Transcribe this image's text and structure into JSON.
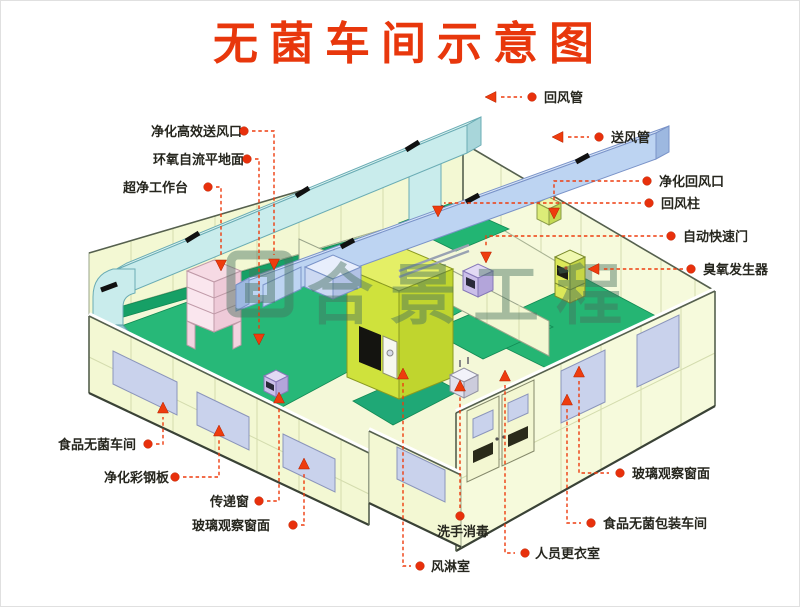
{
  "title": "无菌车间示意图",
  "watermark": {
    "text": "合景工程"
  },
  "colors": {
    "accent_red": "#e8370c",
    "wall_panel": "#f3f8d3",
    "floor_green": "#27b878",
    "return_duct_cyan": "#c9ecec",
    "supply_duct_blue": "#bdd4f2",
    "window_lavender": "#c9d2ec",
    "air_shower_chartreuse": "#cfe23c",
    "watermark_green": "#47725f"
  },
  "labels": [
    {
      "id": "return-air-duct",
      "text": "回风管"
    },
    {
      "id": "supply-air-duct",
      "text": "送风管"
    },
    {
      "id": "purified-return-air-outlet",
      "text": "净化回风口"
    },
    {
      "id": "return-air-column",
      "text": "回风柱"
    },
    {
      "id": "automatic-rapid-door",
      "text": "自动快速门"
    },
    {
      "id": "ozone-generator",
      "text": "臭氧发生器"
    },
    {
      "id": "hepa-supply-outlet",
      "text": "净化高效送风口"
    },
    {
      "id": "epoxy-self-leveling-floor",
      "text": "环氧自流平地面"
    },
    {
      "id": "ultra-clean-workbench",
      "text": "超净工作台"
    },
    {
      "id": "food-sterile-workshop",
      "text": "食品无菌车间"
    },
    {
      "id": "purification-color-steel-panel",
      "text": "净化彩钢板"
    },
    {
      "id": "pass-through-window",
      "text": "传递窗"
    },
    {
      "id": "glass-observation-window-left",
      "text": "玻璃观察窗面"
    },
    {
      "id": "hand-wash-disinfection",
      "text": "洗手消毒"
    },
    {
      "id": "air-shower-room",
      "text": "风淋室"
    },
    {
      "id": "staff-changing-room",
      "text": "人员更衣室"
    },
    {
      "id": "food-sterile-packaging-workshop",
      "text": "食品无菌包装车间"
    },
    {
      "id": "glass-observation-window-right",
      "text": "玻璃观察窗面"
    }
  ]
}
